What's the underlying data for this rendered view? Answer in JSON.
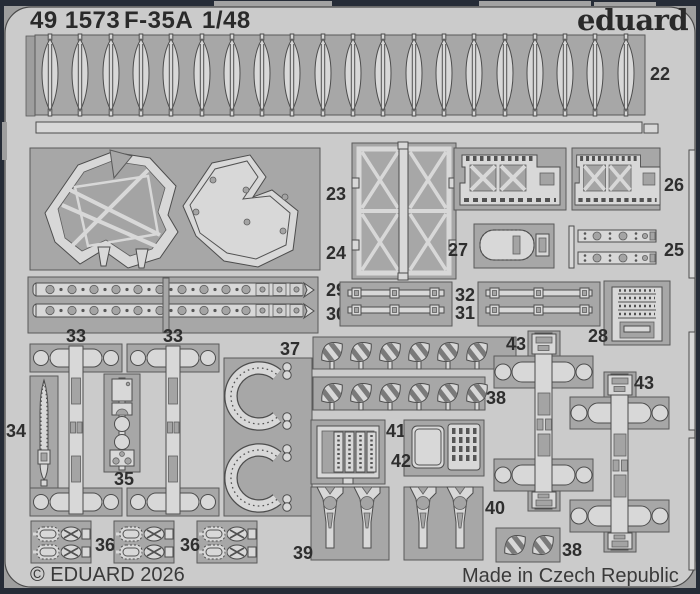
{
  "header": {
    "catalog_number": "49 1573",
    "product": "F-35A",
    "scale": "1/48",
    "brand": "eduard"
  },
  "footer": {
    "copyright": "© EDUARD 2026",
    "origin": "Made in Czech Republic"
  },
  "part_numbers": {
    "p22": "22",
    "p23": "23",
    "p24": "24",
    "p25": "25",
    "p26": "26",
    "p27": "27",
    "p28": "28",
    "p29": "29",
    "p30": "30",
    "p31": "31",
    "p32": "32",
    "p33": "33",
    "p34": "34",
    "p35": "35",
    "p36": "36",
    "p37": "37",
    "p38": "38",
    "p39": "39",
    "p40": "40",
    "p41": "41",
    "p42": "42",
    "p43": "43"
  },
  "colors": {
    "border_frame": "#262c37",
    "backdrop": "#9e9e9e",
    "fret_metal": "#cbcbcb",
    "etched_tray": "#a7a7a7",
    "part_surface": "#d8d8d8",
    "outline": "#4d4d4d",
    "text": "#2e2e2e"
  }
}
